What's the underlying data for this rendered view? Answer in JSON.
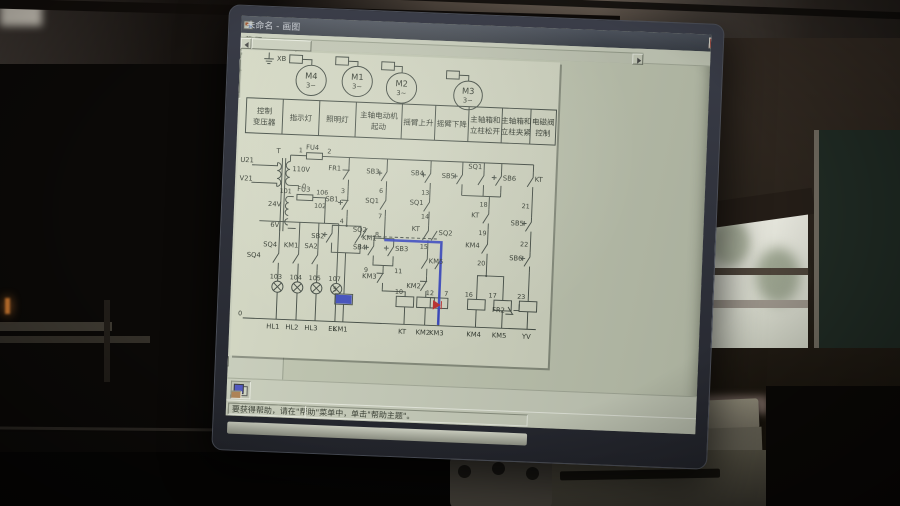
{
  "window": {
    "title": "未命名 - 画图",
    "controls": {
      "minimize": "–",
      "maximize": "□",
      "close": "✕"
    }
  },
  "menu": {
    "items": [
      "文件(F)",
      "编辑(E)",
      "查看(V)",
      "图像(I)",
      "颜色(C)",
      "帮助(H)"
    ]
  },
  "toolbox": {
    "text_glyph": "A",
    "side_label": "K1",
    "close_glyph": "✕"
  },
  "palette": {
    "current": "#4a52c4",
    "row1": [
      "#26231f",
      "#6e6a60",
      "#79333a",
      "#7a6a33",
      "#577a3a",
      "#3a7a55",
      "#3a6e79",
      "#3a4679",
      "#55337a",
      "#79337a",
      "#7a5533",
      "#4d5a40",
      "#46557a",
      "#6b4733"
    ],
    "row2": [
      "#d8d5c6",
      "#a8a599",
      "#c04a50",
      "#c07a3a",
      "#c0b040",
      "#62c060",
      "#40b8b0",
      "#4060c0",
      "#8040c0",
      "#c040b0",
      "#c0d060",
      "#80a890",
      "#7090d0",
      "#b08050"
    ]
  },
  "statusbar": {
    "help": "要获得帮助，请在\"帮助\"菜单中，单击\"帮助主题\"。"
  },
  "blackboard": {
    "chalk": "17 +"
  },
  "schem": {
    "header": [
      {
        "l1": "控制",
        "l2": "变压器"
      },
      {
        "l1": "指示灯",
        "l2": ""
      },
      {
        "l1": "照明灯",
        "l2": ""
      },
      {
        "l1": "主轴电动机",
        "l2": "起动"
      },
      {
        "l1": "摇臂上升",
        "l2": ""
      },
      {
        "l1": "摇臂下降",
        "l2": ""
      },
      {
        "l1": "主轴箱和",
        "l2": "立柱松开"
      },
      {
        "l1": "主轴箱和",
        "l2": "立柱夹紧"
      },
      {
        "l1": "电磁阀",
        "l2": "控制"
      }
    ],
    "t": {
      "xb": "XB",
      "m4": "M4",
      "m1": "M1",
      "m2": "M2",
      "m3": "M3",
      "ph": "3~",
      "u21": "U21",
      "v21": "V21",
      "tT": "T",
      "n1": "1",
      "fu4": "FU4",
      "n2": "2",
      "v110": "110V",
      "n0": "0",
      "n101": "101",
      "fu3": "FU3",
      "n106": "106",
      "v24": "24V",
      "n102": "102",
      "v6": "6V",
      "sq4a": "SQ4",
      "sq4b": "SQ4",
      "km1a": "KM1",
      "sa2": "SA2",
      "n103": "103",
      "n104": "104",
      "n105": "105",
      "n107": "107",
      "hl1": "HL1",
      "hl2": "HL2",
      "hl3": "HL3",
      "el": "EL",
      "fr1": "FR1",
      "n3": "3",
      "sb1": "SB1",
      "n4": "4",
      "sb2": "SB2",
      "km1b": "KM1",
      "n5": "5",
      "km1c": "KM1",
      "sb3a": "SB3",
      "n6": "6",
      "sq1a": "SQ1",
      "n7": "7",
      "n8": "8",
      "sb4b": "SB4",
      "sb3b": "SB3",
      "n9": "9",
      "n11": "11",
      "km3a": "KM3",
      "n10": "10",
      "ktd": "KT",
      "sb4a": "SB4",
      "n13": "13",
      "sq1b": "SQ1",
      "n14": "14",
      "kta": "KT",
      "n15": "15",
      "km5a": "KM5",
      "km2a": "KM2",
      "km2b": "KM2",
      "sq2a": "SQ2",
      "sq2b": "SQ2",
      "n12": "12",
      "red7": "7",
      "km3b": "KM3",
      "sb5a": "SB5",
      "sq1c": "SQ1",
      "sb6a": "SB6",
      "n18": "18",
      "ktc": "KT",
      "n19": "19",
      "km4a": "KM4",
      "n20": "20",
      "n16": "16",
      "n17": "17",
      "km4b": "KM4",
      "km5b": "KM5",
      "ktb": "KT",
      "n21": "21",
      "sb5b": "SB5",
      "n22": "22",
      "sb6b": "SB6",
      "n23": "23",
      "fr2": "FR2",
      "yvb": "YV",
      "n0b": "0"
    }
  }
}
